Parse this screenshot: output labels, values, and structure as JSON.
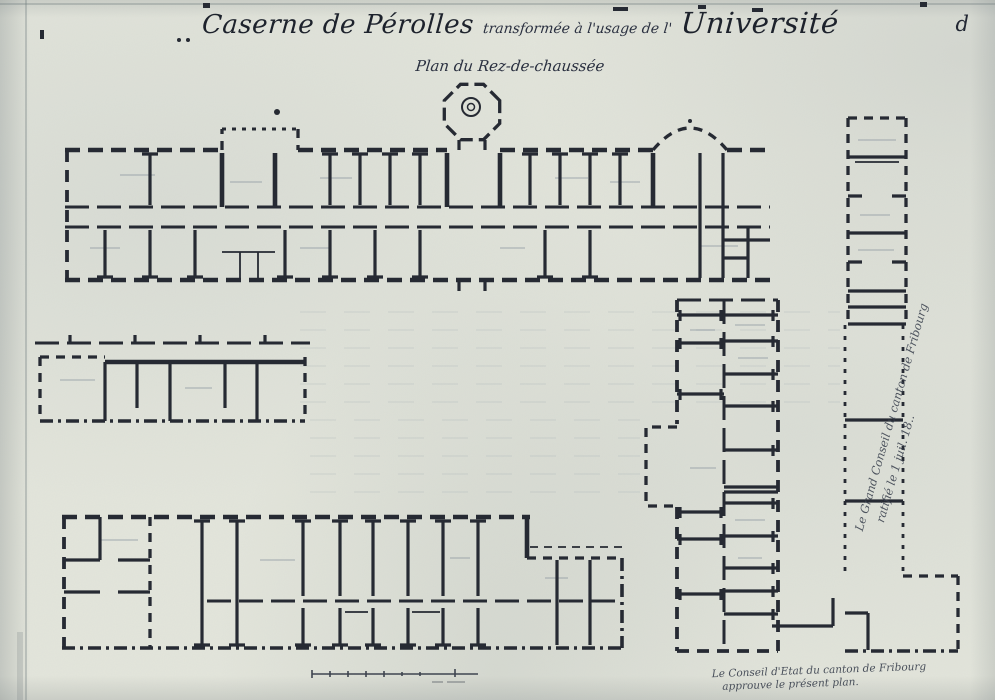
{
  "document": {
    "title_part1": "Caserne de Pérolles",
    "title_part2": "transformée à l'usage de l'",
    "title_part3": "Université",
    "subtitle": "Plan du Rez-de-chaussée",
    "plate_letter": "d"
  },
  "annotations": {
    "grand_conseil_line1": "Le Grand Conseil du canton de Fribourg",
    "grand_conseil_line2": "ratifié le 1 juil. 18..",
    "conseil_etat_line1": "Le Conseil d'Etat du canton de Fribourg",
    "conseil_etat_line2": "approuve le présent plan."
  },
  "colors": {
    "paper": "#e3e5db",
    "ink": "#262a33",
    "faint_ink": "#8b96a0"
  }
}
